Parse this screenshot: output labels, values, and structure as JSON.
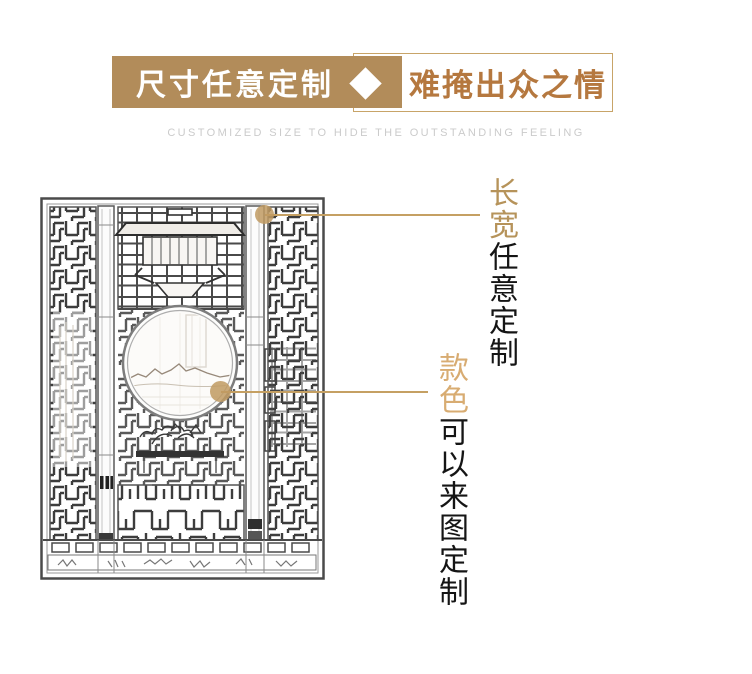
{
  "banner": {
    "left_label": "尺寸任意定制",
    "right_label": "难掩出众之情",
    "subtitle": "CUSTOMIZED SIZE TO HIDE THE OUTSTANDING FEELING",
    "colors": {
      "tan_box": "#b28c5a",
      "right_box_text": "#b5783f",
      "box_border": "#c8a468",
      "diamond": "#ffffff",
      "subtitle_gray": "#cbcbcb"
    }
  },
  "callouts": [
    {
      "highlight": "长宽",
      "rest": "任意定制",
      "highlight_color": "#b6935a"
    },
    {
      "highlight": "款色",
      "rest": "可以来图定制",
      "highlight_color": "#d8ac72"
    }
  ],
  "callout_style": {
    "line_color": "#c5a063",
    "dot_color": "#c09a61",
    "body_text_color": "#151515"
  },
  "illustration": {
    "name": "chinese-lattice-screen-pencil-sketch",
    "features": "carved wood partition, moon window with mountain landscape, bonsai table sketch, fretwork lattice panels"
  },
  "icons": {
    "diamond": "white-diamond-shape",
    "callout_dot": "gold-dot-marker"
  }
}
